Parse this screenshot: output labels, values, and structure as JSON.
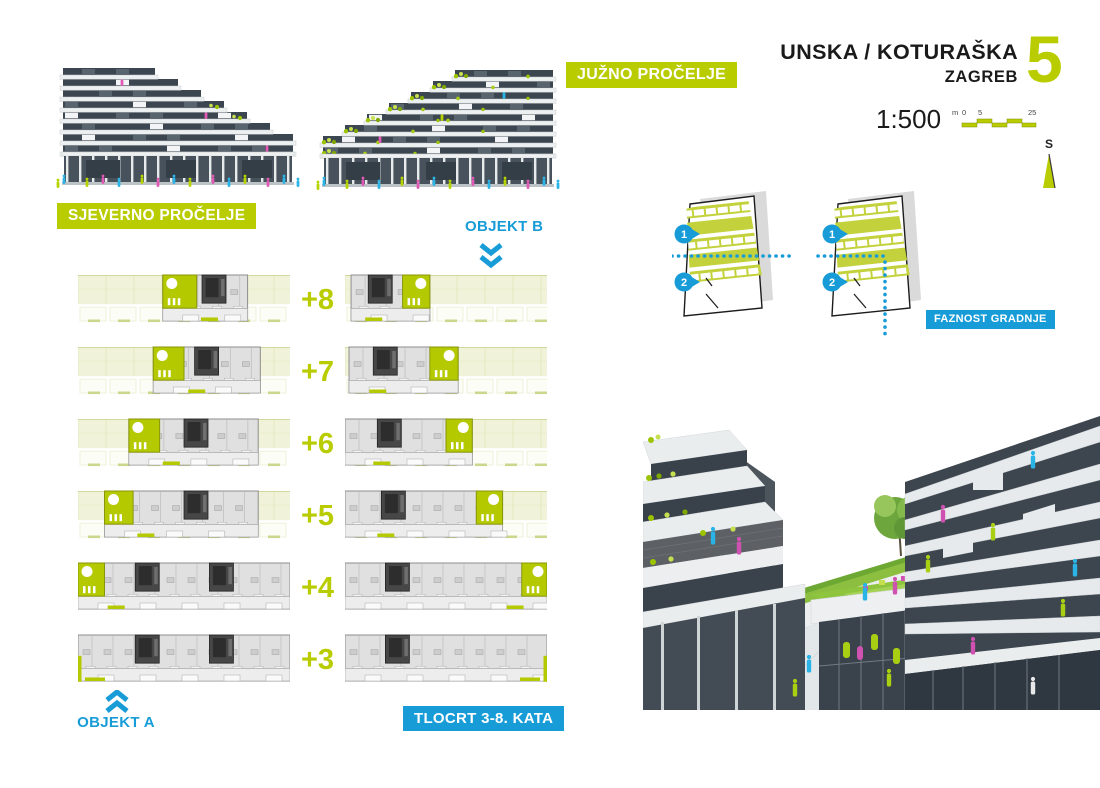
{
  "colors": {
    "green": "#b9cc00",
    "blue": "#189cd8",
    "pale_roof": "#f0f3d9",
    "terrace_green": "#b5c900",
    "plan_gray": "#e0e0e0",
    "core_dark": "#474747"
  },
  "header": {
    "project": "UNSKA / KOTURAŠKA",
    "city": "ZAGREB",
    "sheet_number": "5",
    "scale": "1:500",
    "scalebar_unit": "m",
    "scalebar_ticks": [
      "0",
      "5",
      "25"
    ],
    "north_letter": "S"
  },
  "labels": {
    "north_facade": "SJEVERNO PROČELJE",
    "south_facade": "JUŽNO PROČELJE",
    "object_a": "OBJEKT A",
    "object_b": "OBJEKT B",
    "plans_caption": "TLOCRT 3-8. KATA",
    "phasing_caption": "FAZNOST GRADNJE"
  },
  "phasing_markers": [
    "1",
    "2"
  ],
  "floors": [
    {
      "label": "+8",
      "left": {
        "roof": true,
        "built": [
          0.4,
          0.8
        ],
        "terrace": [
          0.4,
          0.56
        ],
        "cores": [
          0.585
        ],
        "sill": 0.58
      },
      "right": {
        "roof": true,
        "built": [
          0.03,
          0.42
        ],
        "terrace": [
          0.285,
          0.42
        ],
        "cores": [
          0.115
        ],
        "sill": 0.1,
        "circleRight": true
      }
    },
    {
      "label": "+7",
      "left": {
        "roof": true,
        "built": [
          0.355,
          0.86
        ],
        "terrace": [
          0.355,
          0.5
        ],
        "cores": [
          0.55
        ],
        "sill": 0.52
      },
      "right": {
        "roof": true,
        "built": [
          0.02,
          0.56
        ],
        "terrace": [
          0.42,
          0.56
        ],
        "cores": [
          0.14
        ],
        "sill": 0.12,
        "circleRight": true
      }
    },
    {
      "label": "+6",
      "left": {
        "roof": true,
        "built": [
          0.24,
          0.85
        ],
        "terrace": [
          0.24,
          0.385
        ],
        "cores": [
          0.5
        ],
        "sill": 0.4
      },
      "right": {
        "roof": true,
        "built": [
          0.0,
          0.63
        ],
        "terrace": [
          0.5,
          0.63
        ],
        "cores": [
          0.16
        ],
        "sill": 0.14,
        "circleRight": true
      }
    },
    {
      "label": "+5",
      "left": {
        "roof": true,
        "built": [
          0.125,
          0.85
        ],
        "terrace": [
          0.125,
          0.26
        ],
        "cores": [
          0.5
        ],
        "sill": 0.28
      },
      "right": {
        "roof": true,
        "built": [
          0.0,
          0.78
        ],
        "terrace": [
          0.65,
          0.78
        ],
        "cores": [
          0.18
        ],
        "sill": 0.16,
        "circleRight": true
      }
    },
    {
      "label": "+4",
      "left": {
        "roof": false,
        "built": [
          0.0,
          1.0
        ],
        "terrace": [
          0.0,
          0.125
        ],
        "cores": [
          0.27,
          0.62
        ],
        "sill": 0.14
      },
      "right": {
        "roof": false,
        "built": [
          0.0,
          1.0
        ],
        "terrace": [
          0.875,
          1.0
        ],
        "cores": [
          0.2
        ],
        "sill": 0.8,
        "circleRight": true
      }
    },
    {
      "label": "+3",
      "left": {
        "roof": false,
        "built": [
          0.0,
          1.0
        ],
        "cores": [
          0.27,
          0.62
        ],
        "endBar": "left"
      },
      "right": {
        "roof": false,
        "built": [
          0.0,
          1.0
        ],
        "cores": [
          0.2
        ],
        "endBar": "right"
      }
    }
  ]
}
